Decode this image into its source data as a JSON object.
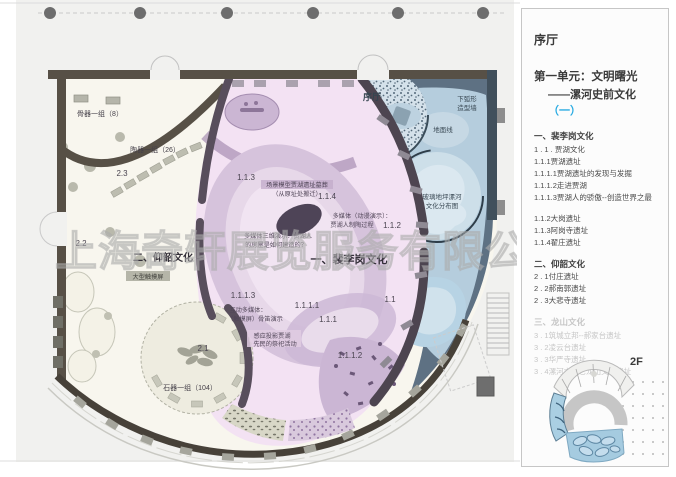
{
  "watermark": "上海奇轩展览服务有限公司",
  "colors": {
    "accent_blue": "#29abe2",
    "wall_dark": "#575046",
    "partition_purple": "#544a58",
    "zone_pink": "#f3e2f3",
    "zone_cream": "#f8f6ee",
    "zone_blue_dark": "#5e7183",
    "zone_blue_light": "#b5cddd",
    "oval_purple": "#d6c3dc",
    "dim_text": "#c6c6c6"
  },
  "panel": {
    "title": "序厅",
    "unit_line1": "第一单元：文明曙光",
    "unit_line2_prefix": "——漯河史前文化",
    "unit_line2_accent": "（一）",
    "list": [
      {
        "text": "一、裴李岗文化"
      },
      {
        "text": "1 . 1 . 贾湖文化"
      },
      {
        "text": "1.1.1贾湖遗址"
      },
      {
        "text": "1.1.1.1贾湖遗址的发现与发掘"
      },
      {
        "text": "1.1.1.2走进贾湖"
      },
      {
        "text": "1.1.1.3贾湖人的骄傲--创造世界之最"
      },
      {
        "text": "1.1.2大岗遗址"
      },
      {
        "text": "1.1.3阿岗寺遗址"
      },
      {
        "text": "1.1.4翟庄遗址"
      },
      {
        "text": "二、仰韶文化"
      },
      {
        "text": "2 . 1付庄遗址"
      },
      {
        "text": "2 . 2郝南郭遗址"
      },
      {
        "text": "2 . 3大悲寺遗址"
      },
      {
        "text": "三、龙山文化"
      },
      {
        "text": "3 . 1筑城立邦--郝家台遗址"
      },
      {
        "text": "3 . 2凌云台遗址"
      },
      {
        "text": "3 . 3华严寺遗址"
      },
      {
        "text": "3 . 4漯河市其它龙山文化遗址"
      }
    ],
    "floor_label": "2F"
  },
  "plan": {
    "hall": "序厅",
    "bone_group": "骨器一组（8）",
    "pottery_group": "陶器一组（26）",
    "stone_group": "石器一组（104）",
    "large_touchscreen": "大型触摸屏",
    "yangshao_title": "二、仰韶文化",
    "peiligang_title": "一、裴李岗文化",
    "zone_23": "2.3",
    "zone_22": "2.2",
    "zone_21": "2.1",
    "zone_113": "1.1.3",
    "zone_114": "1.1.4",
    "zone_112": "1.1.2",
    "zone_1113": "1.1.1.3",
    "zone_1111": "1.1.1.1",
    "zone_111": "1.1.1",
    "zone_11": "1.1",
    "zone_1112": "1.1.1.2",
    "scene_model_l1": "场景模型贾湖遗址墓葬",
    "scene_model_l2": "（从原址处搬迁）",
    "mm_anim_l1": "多媒体（动漫演示）：",
    "mm_anim_l2": "贾湖人制陶过程",
    "mm_3d_l1": "多媒体三维演示：贾湖人",
    "mm_3d_l2": "的房屋是如何建造的？",
    "interactive_l1": "互动多媒体：",
    "interactive_l2": "（触摸屏）骨笛演示",
    "sensor_l1": "感应投影贾湖",
    "sensor_l2": "先民的祭祀活动",
    "ground_line": "地面线",
    "arc_wall_l1": "下弧形",
    "arc_wall_l2": "造型墙",
    "glass_floor_l1": "玻璃地坪漯河",
    "glass_floor_l2": "文化分布图"
  }
}
